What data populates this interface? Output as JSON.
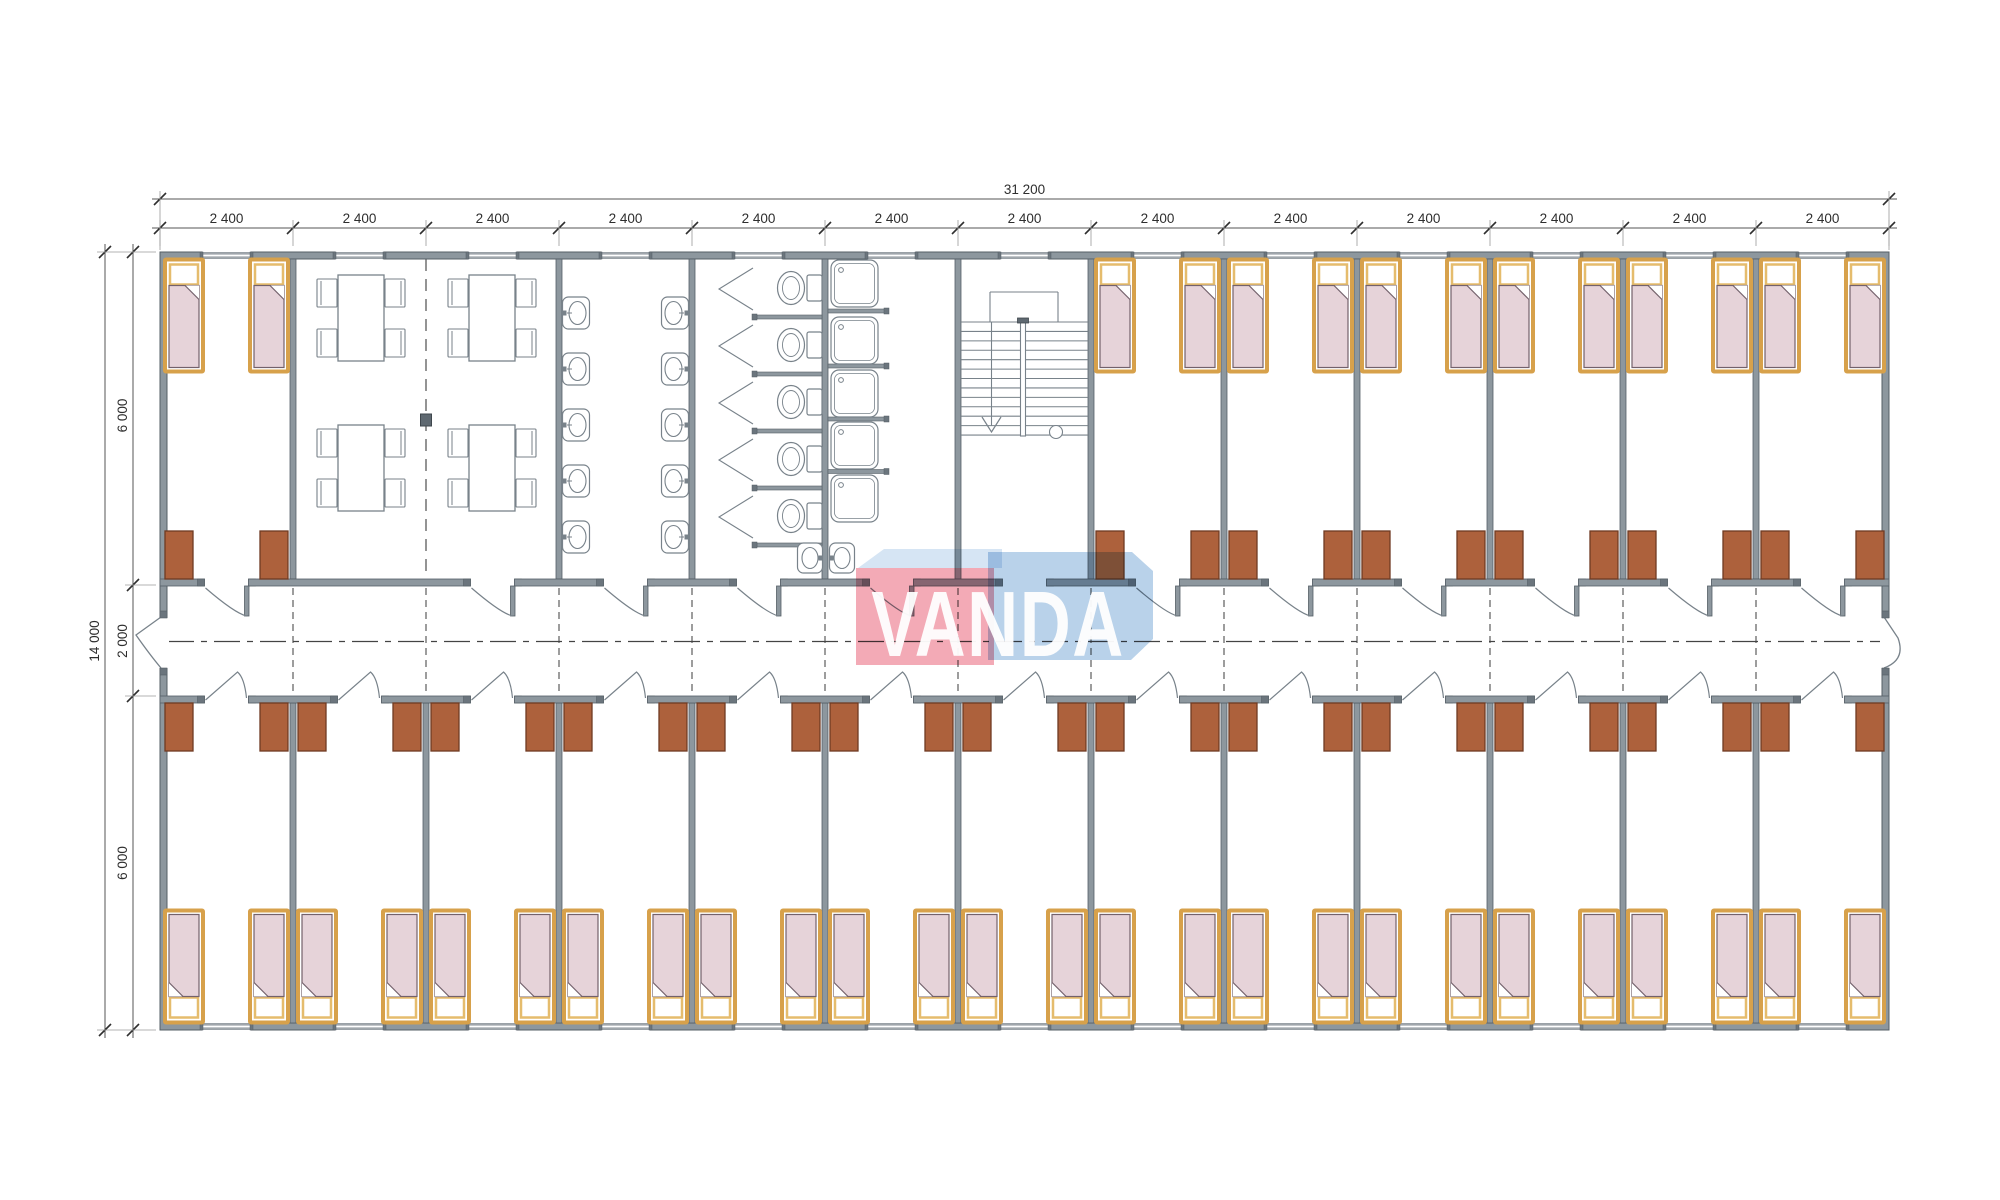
{
  "title": "modular-dormitory-floor-plan",
  "dimensions": {
    "overall_width": "31 200",
    "bay_width": "2 400",
    "bay_count": 13,
    "overall_depth": "14 000",
    "depth_segments": [
      "6 000",
      "2 000",
      "6 000"
    ]
  },
  "logo": {
    "text": "VANDA"
  },
  "plan": {
    "top_row_types": [
      "bedroom",
      "dining",
      "dining",
      "washroom",
      "wc",
      "shower",
      "stairs",
      "bedroom",
      "bedroom",
      "bedroom",
      "bedroom",
      "bedroom",
      "bedroom"
    ],
    "bottom_row_types": [
      "bedroom",
      "bedroom",
      "bedroom",
      "bedroom",
      "bedroom",
      "bedroom",
      "bedroom",
      "bedroom",
      "bedroom",
      "bedroom",
      "bedroom",
      "bedroom",
      "bedroom"
    ],
    "fixtures": {
      "beds_per_bedroom": 2,
      "wardrobes_per_bedroom": 2,
      "dining_tables": 4,
      "chairs_per_table": 4,
      "washroom_basins_per_side": 5,
      "wc_toilets": 5,
      "wc_corner_basins": 1,
      "shower_trays": 5,
      "shower_corner_basins": 1,
      "stair_tread_lines": 13
    }
  },
  "colors": {
    "wall": "#8d979e",
    "wallEdge": "#555f66",
    "wallCap": "#6b757d",
    "fixture": "#78828a",
    "bedFrame": "#d7a14b",
    "bedFrameLight": "#e5bc6d",
    "blanket": "#e6d3d9",
    "blanketEdge": "#73616b",
    "wardrobe": "#ad613c",
    "wardrobeEdge": "#6f3a22",
    "dash": "#4d4d4d",
    "dimLine": "#555555",
    "dimTick": "#2e2e2e",
    "extLine": "#9a9a9a",
    "column": "#5f6971",
    "logoRed": "#f3aab6",
    "logoBlue": "#b9d2ea",
    "logoBand": "#d6e5f4",
    "logoText": "#ffffff"
  }
}
